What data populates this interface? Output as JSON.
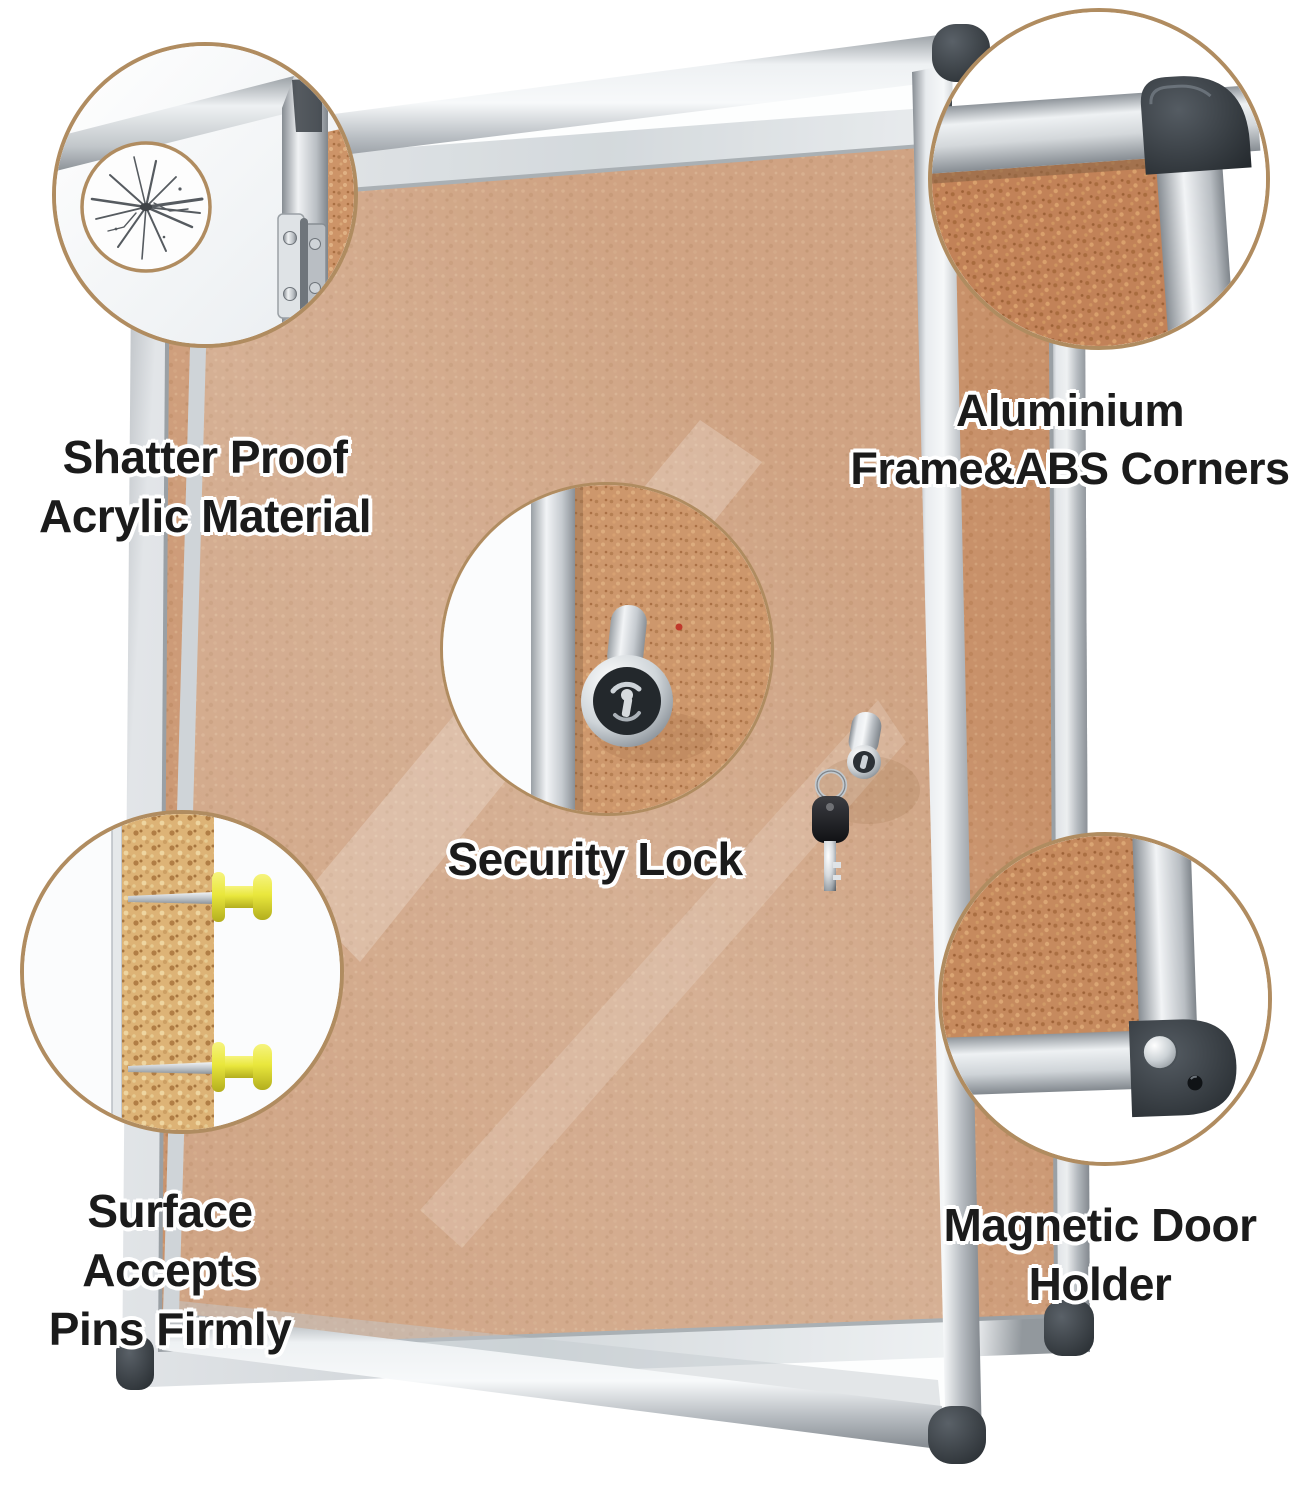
{
  "labels": {
    "shatterproof": {
      "line1": "Shatter Proof",
      "line2": "Acrylic Material"
    },
    "aluminium": {
      "line1": "Aluminium",
      "line2": "Frame&ABS Corners"
    },
    "security": {
      "line1": "Security Lock"
    },
    "pins": {
      "line1": "Surface Accepts",
      "line2": "Pins Firmly"
    },
    "magnetic": {
      "line1": "Magnetic Door",
      "line2": "Holder"
    }
  },
  "colors": {
    "background": "#ffffff",
    "callout_border": "#b08c60",
    "cork": "#c8916a",
    "cork_cross_section": "#ddb376",
    "aluminium_light": "#f6f8f9",
    "aluminium_dark": "#868c92",
    "abs_corner": "#2c3237",
    "push_pin_yellow": "#e9e73c",
    "label_text": "#1b1b1b",
    "label_outline": "#ffffff"
  }
}
